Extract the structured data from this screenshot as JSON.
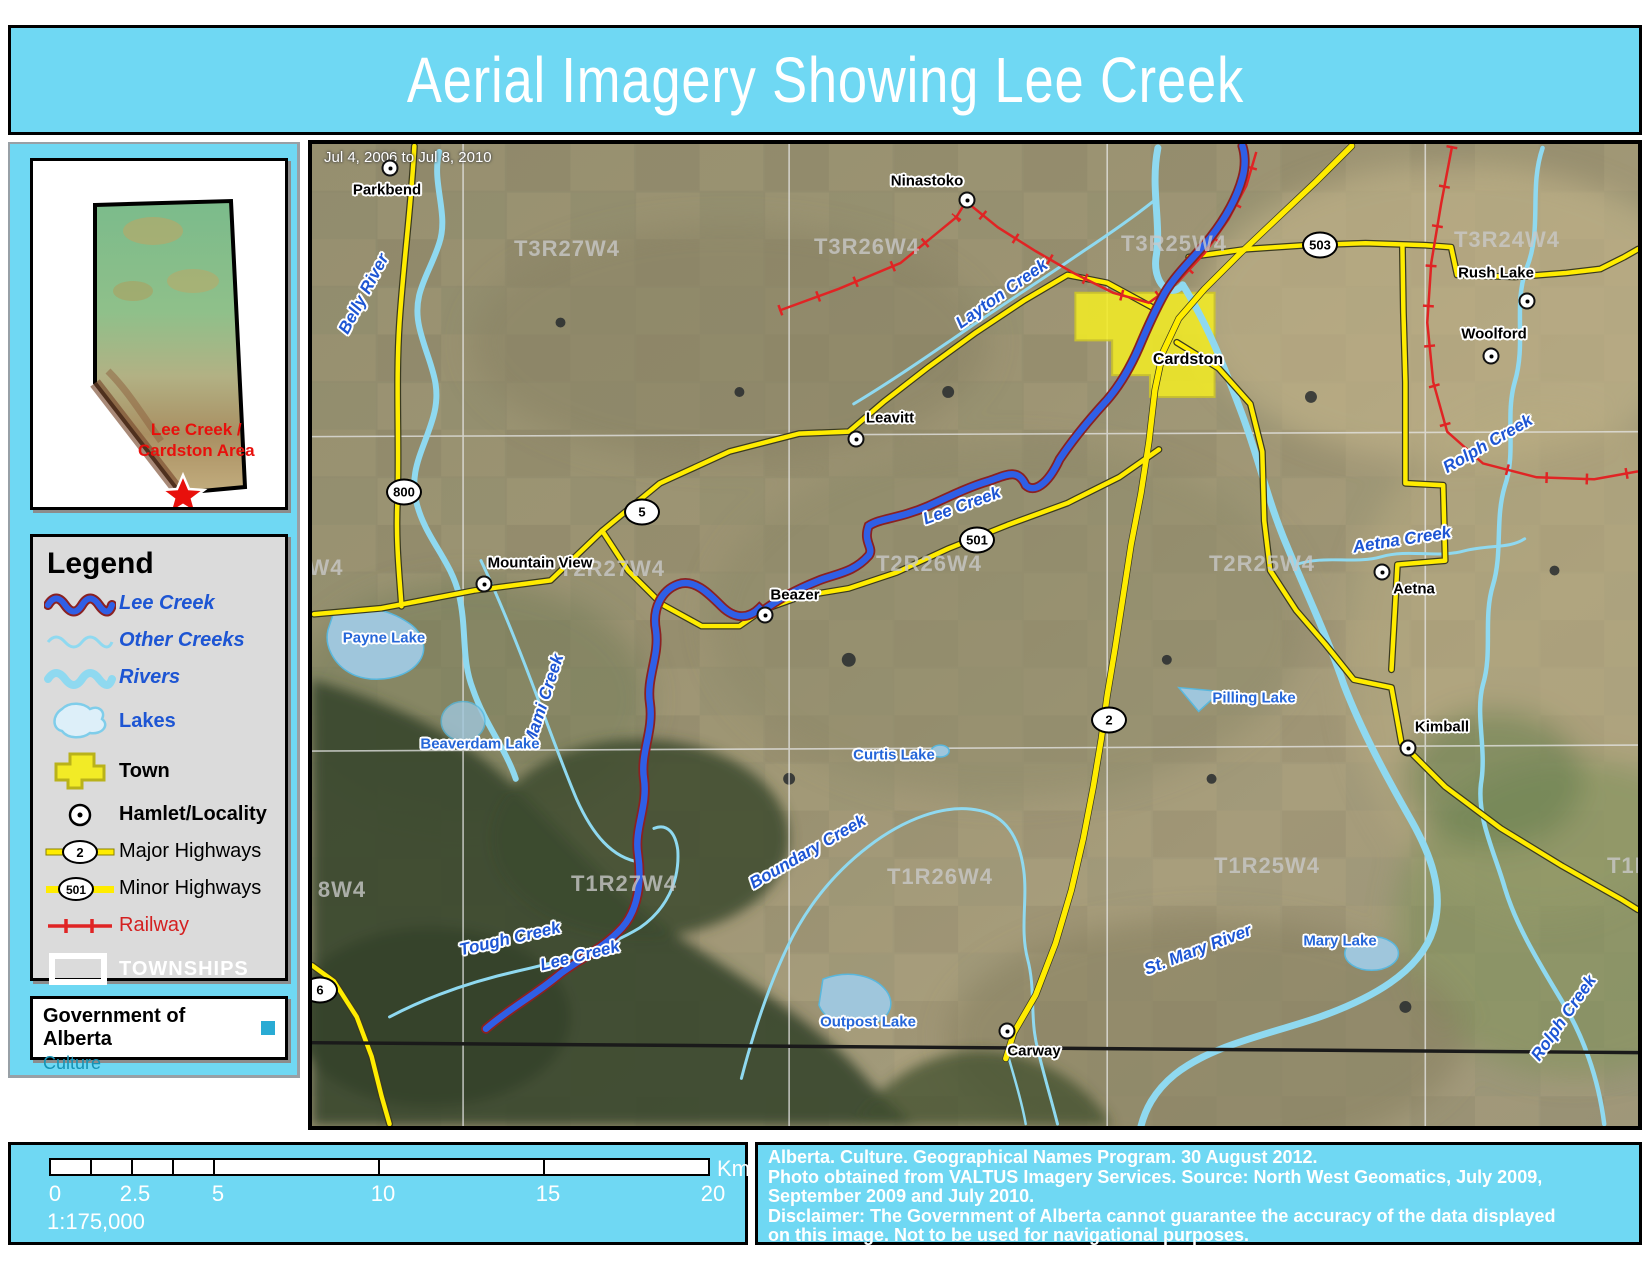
{
  "title": "Aerial Imagery Showing Lee Creek",
  "colors": {
    "cyan": "#6fd8f3",
    "legend_gray": "#dbdbdb",
    "teal": "#1693b5",
    "water_light_blue": "#8fd9f0",
    "lee_creek_blue": "#2f5fe6",
    "lee_creek_casing": "#8b2121",
    "road_yellow": "#ffec00",
    "railway_red": "#e02424",
    "water_label_blue": "#1d55d3",
    "town_yellow": "#f2eb26"
  },
  "inset": {
    "line1": "Lee Creek /",
    "line2": "Cardston Area"
  },
  "legend": {
    "heading": "Legend",
    "items": [
      {
        "label": "Lee Creek",
        "kind": "lee"
      },
      {
        "label": "Other Creeks",
        "kind": "creek"
      },
      {
        "label": "Rivers",
        "kind": "river"
      },
      {
        "label": "Lakes",
        "kind": "lake"
      },
      {
        "label": "Town",
        "kind": "town"
      },
      {
        "label": "Hamlet/Locality",
        "kind": "hamlet"
      },
      {
        "label": "Major Highways",
        "kind": "major",
        "badge": "2"
      },
      {
        "label": "Minor Highways",
        "kind": "minor",
        "badge": "501"
      },
      {
        "label": "Railway",
        "kind": "railway"
      },
      {
        "label": "TOWNSHIPS",
        "kind": "township"
      }
    ]
  },
  "gov": {
    "name": "Government of Alberta",
    "dept": "Culture"
  },
  "map": {
    "date_range": "Jul 4, 2006 to Jul 8, 2010",
    "town_label": "Cardston",
    "townships": [
      {
        "t": "T3R27W4",
        "x": 255,
        "y": 105
      },
      {
        "t": "T3R26W4",
        "x": 555,
        "y": 103
      },
      {
        "t": "T3R25W4",
        "x": 862,
        "y": 100
      },
      {
        "t": "T3R24W4",
        "x": 1195,
        "y": 96
      },
      {
        "t": "W4",
        "x": 14,
        "y": 424
      },
      {
        "t": "T2R27W4",
        "x": 300,
        "y": 425
      },
      {
        "t": "T2R26W4",
        "x": 617,
        "y": 420
      },
      {
        "t": "T2R25W4",
        "x": 950,
        "y": 420
      },
      {
        "t": "8W4",
        "x": 30,
        "y": 746
      },
      {
        "t": "T1R27W4",
        "x": 312,
        "y": 740
      },
      {
        "t": "T1R26W4",
        "x": 628,
        "y": 733
      },
      {
        "t": "T1R25W4",
        "x": 955,
        "y": 722
      },
      {
        "t": "T1R24W4",
        "x": 1348,
        "y": 722
      }
    ],
    "hamlets": [
      {
        "name": "Parkbend",
        "dx": 78,
        "dy": 24,
        "lx": 75,
        "ly": 46
      },
      {
        "name": "Ninastoko",
        "dx": 655,
        "dy": 56,
        "lx": 615,
        "ly": 37
      },
      {
        "name": "Leavitt",
        "dx": 544,
        "dy": 295,
        "lx": 578,
        "ly": 274
      },
      {
        "name": "Mountain View",
        "dx": 172,
        "dy": 440,
        "lx": 228,
        "ly": 419
      },
      {
        "name": "Beazer",
        "dx": 453,
        "dy": 471,
        "lx": 483,
        "ly": 451
      },
      {
        "name": "Aetna",
        "dx": 1070,
        "dy": 428,
        "lx": 1102,
        "ly": 445
      },
      {
        "name": "Kimball",
        "dx": 1096,
        "dy": 604,
        "lx": 1130,
        "ly": 583
      },
      {
        "name": "Rush Lake",
        "dx": 1215,
        "dy": 157,
        "lx": 1184,
        "ly": 129
      },
      {
        "name": "Woolford",
        "dx": 1179,
        "dy": 212,
        "lx": 1182,
        "ly": 190
      },
      {
        "name": "Carway",
        "dx": 695,
        "dy": 887,
        "lx": 722,
        "ly": 907
      }
    ],
    "shields": [
      {
        "n": "503",
        "x": 1008,
        "y": 101
      },
      {
        "n": "800",
        "x": 92,
        "y": 348
      },
      {
        "n": "5",
        "x": 330,
        "y": 368
      },
      {
        "n": "501",
        "x": 665,
        "y": 396
      },
      {
        "n": "2",
        "x": 797,
        "y": 576
      },
      {
        "n": "6",
        "x": 8,
        "y": 846
      }
    ],
    "water_labels": [
      {
        "t": "Belly River",
        "x": 52,
        "y": 150,
        "r": -62
      },
      {
        "t": "Layton Creek",
        "x": 690,
        "y": 150,
        "r": -35
      },
      {
        "t": "Lee Creek",
        "x": 650,
        "y": 362,
        "r": -20
      },
      {
        "t": "Lee Creek",
        "x": 268,
        "y": 812,
        "r": -14
      },
      {
        "t": "Mami Creek",
        "x": 232,
        "y": 556,
        "r": -72
      },
      {
        "t": "Tough Creek",
        "x": 198,
        "y": 795,
        "r": -13
      },
      {
        "t": "Boundary Creek",
        "x": 496,
        "y": 708,
        "r": -30
      },
      {
        "t": "Rolph Creek",
        "x": 1176,
        "y": 300,
        "r": -30
      },
      {
        "t": "Rolph Creek",
        "x": 1252,
        "y": 874,
        "r": -55
      },
      {
        "t": "Aetna Creek",
        "x": 1090,
        "y": 396,
        "r": -9
      },
      {
        "t": "St. Mary River",
        "x": 886,
        "y": 806,
        "r": -21
      }
    ],
    "lake_labels": [
      {
        "t": "Payne Lake",
        "x": 72,
        "y": 494
      },
      {
        "t": "Beaverdam Lake",
        "x": 168,
        "y": 600
      },
      {
        "t": "Curtis Lake",
        "x": 582,
        "y": 611
      },
      {
        "t": "Outpost Lake",
        "x": 556,
        "y": 878
      },
      {
        "t": "Pilling Lake",
        "x": 942,
        "y": 554
      },
      {
        "t": "Mary Lake",
        "x": 1028,
        "y": 797
      }
    ]
  },
  "scalebar": {
    "numbers": [
      "0",
      "2.5",
      "5",
      "10",
      "15",
      "20"
    ],
    "unit": "Km",
    "ratio": "1:175,000"
  },
  "attribution": {
    "lines": [
      "Alberta. Culture. Geographical Names Program. 30 August 2012.",
      "Photo obtained from VALTUS Imagery Services. Source: North West Geomatics, July 2009,",
      "September 2009 and July 2010.",
      "Disclaimer: The Government of Alberta cannot guarantee the accuracy of the data displayed",
      "on this image. Not to be used for navigational purposes."
    ]
  }
}
